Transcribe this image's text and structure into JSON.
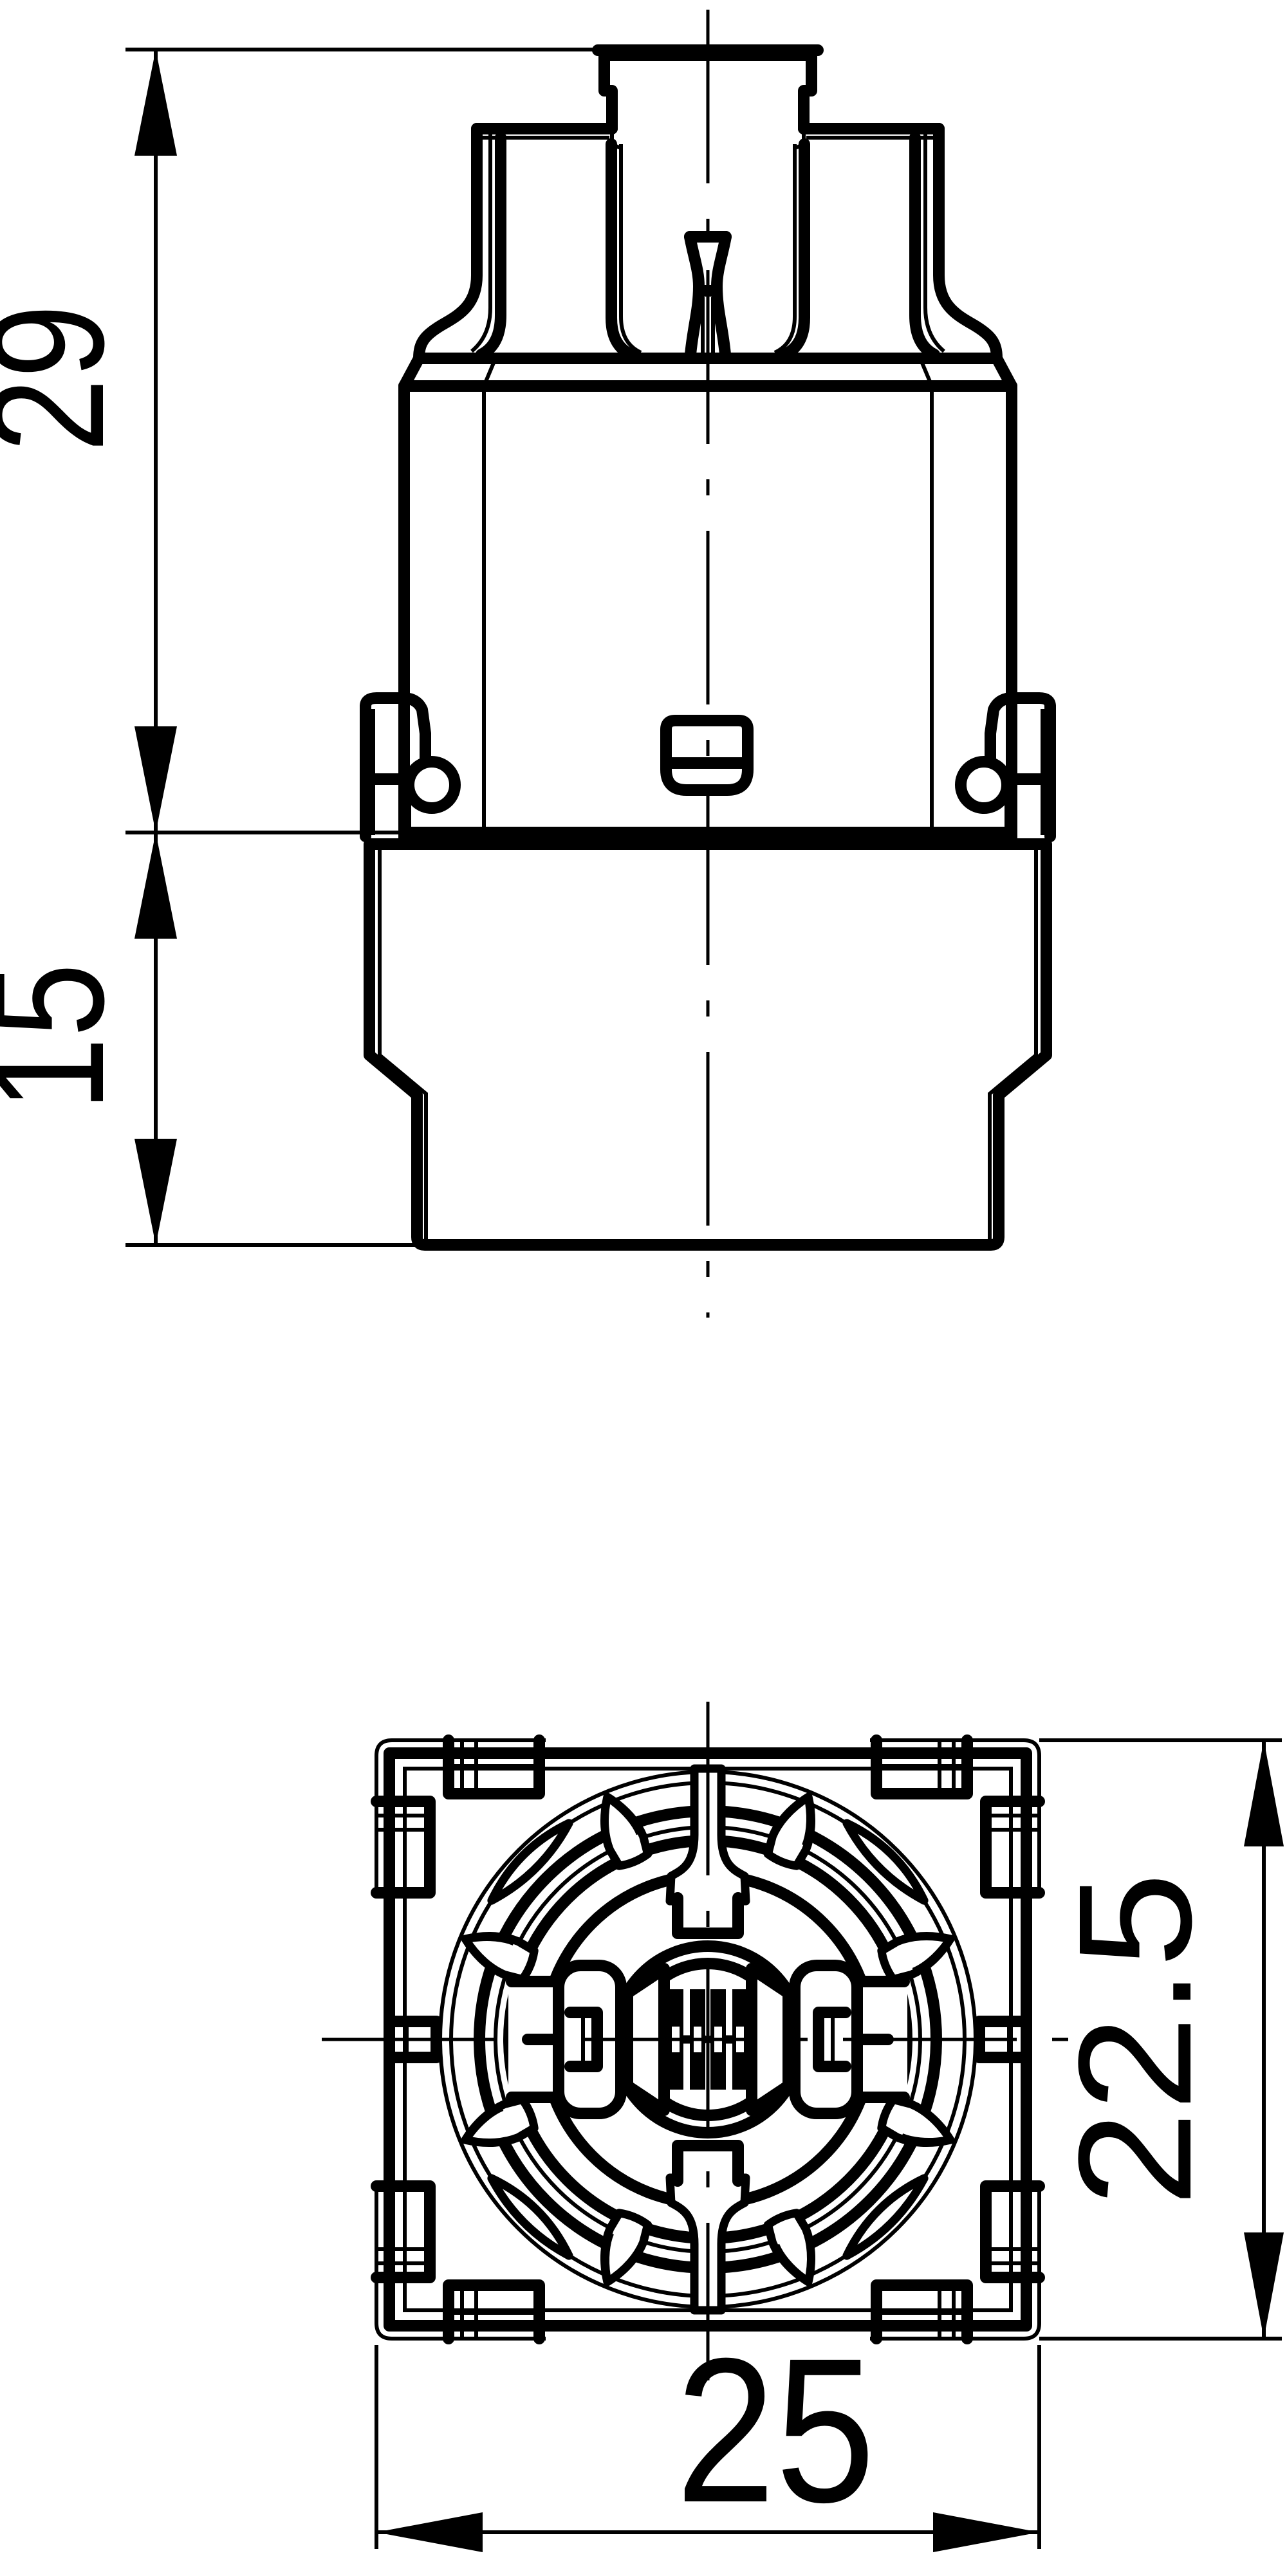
{
  "drawing": {
    "type": "technical-drawing",
    "background_color": "#ffffff",
    "line_color": "#000000",
    "views": {
      "front": {
        "name": "front elevation view"
      },
      "bottom": {
        "name": "bottom face view"
      }
    },
    "dimensions": {
      "upper_body_height": {
        "value": "29"
      },
      "lower_body_height": {
        "value": "15"
      },
      "face_height": {
        "value": "22.5"
      },
      "face_width": {
        "value": "25"
      }
    }
  }
}
